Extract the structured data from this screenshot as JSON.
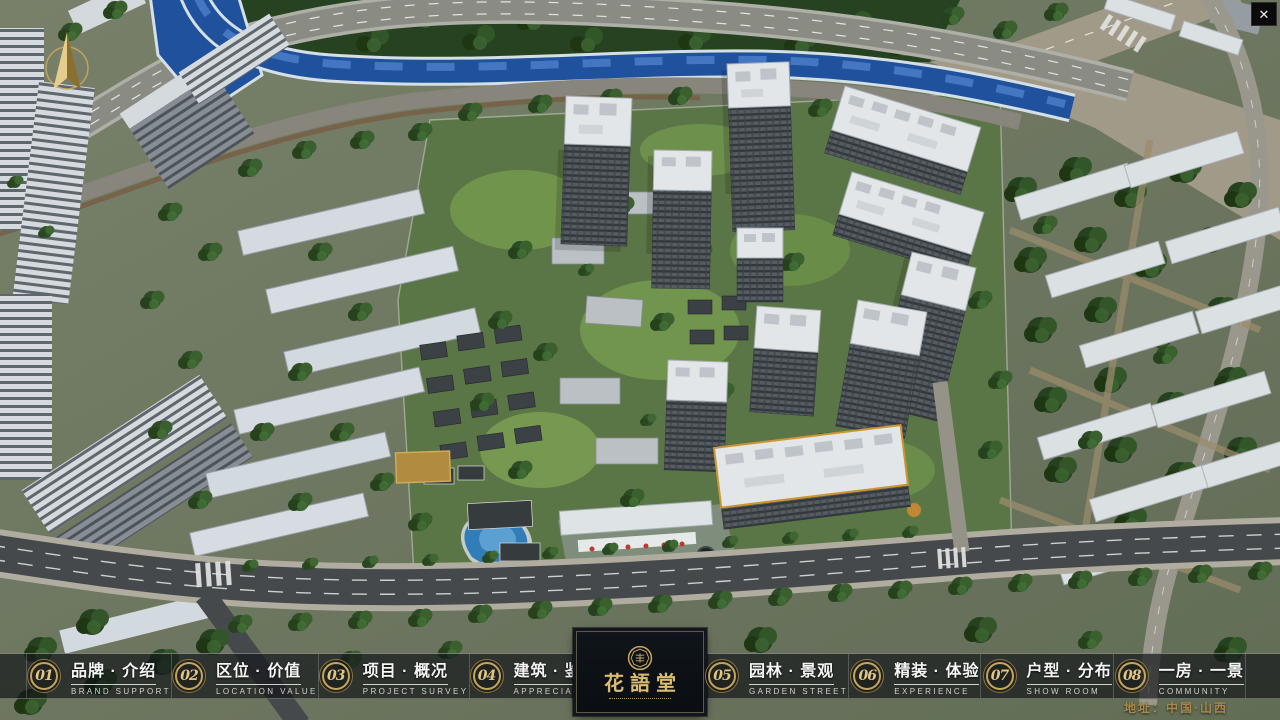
{
  "header": {
    "close_icon": "✕"
  },
  "nav": {
    "items": [
      {
        "num": "01",
        "title": "品牌 · 介绍",
        "subtitle": "BRAND SUPPORT"
      },
      {
        "num": "02",
        "title": "区位 · 价值",
        "subtitle": "LOCATION VALUE"
      },
      {
        "num": "03",
        "title": "项目 · 概况",
        "subtitle": "PROJECT SURVEY"
      },
      {
        "num": "04",
        "title": "建筑 · 鉴赏",
        "subtitle": "APPRECIATION"
      },
      {
        "num": "05",
        "title": "园林 · 景观",
        "subtitle": "GARDEN STREET"
      },
      {
        "num": "06",
        "title": "精装 · 体验",
        "subtitle": "EXPERIENCE"
      },
      {
        "num": "07",
        "title": "户型 · 分布",
        "subtitle": "SHOW ROOM"
      },
      {
        "num": "08",
        "title": "一房 · 一景",
        "subtitle": "COMMUNITY"
      }
    ]
  },
  "logo": {
    "name": "花語堂"
  },
  "footer": {
    "address": "地址：中国·山西"
  },
  "colors": {
    "gold": "#C5A45E",
    "badge_number": "#E0C584",
    "address_gold": "#A9894B",
    "river_blue": "#1D50A2",
    "bar_bg": "rgba(8,10,13,0.62)"
  }
}
